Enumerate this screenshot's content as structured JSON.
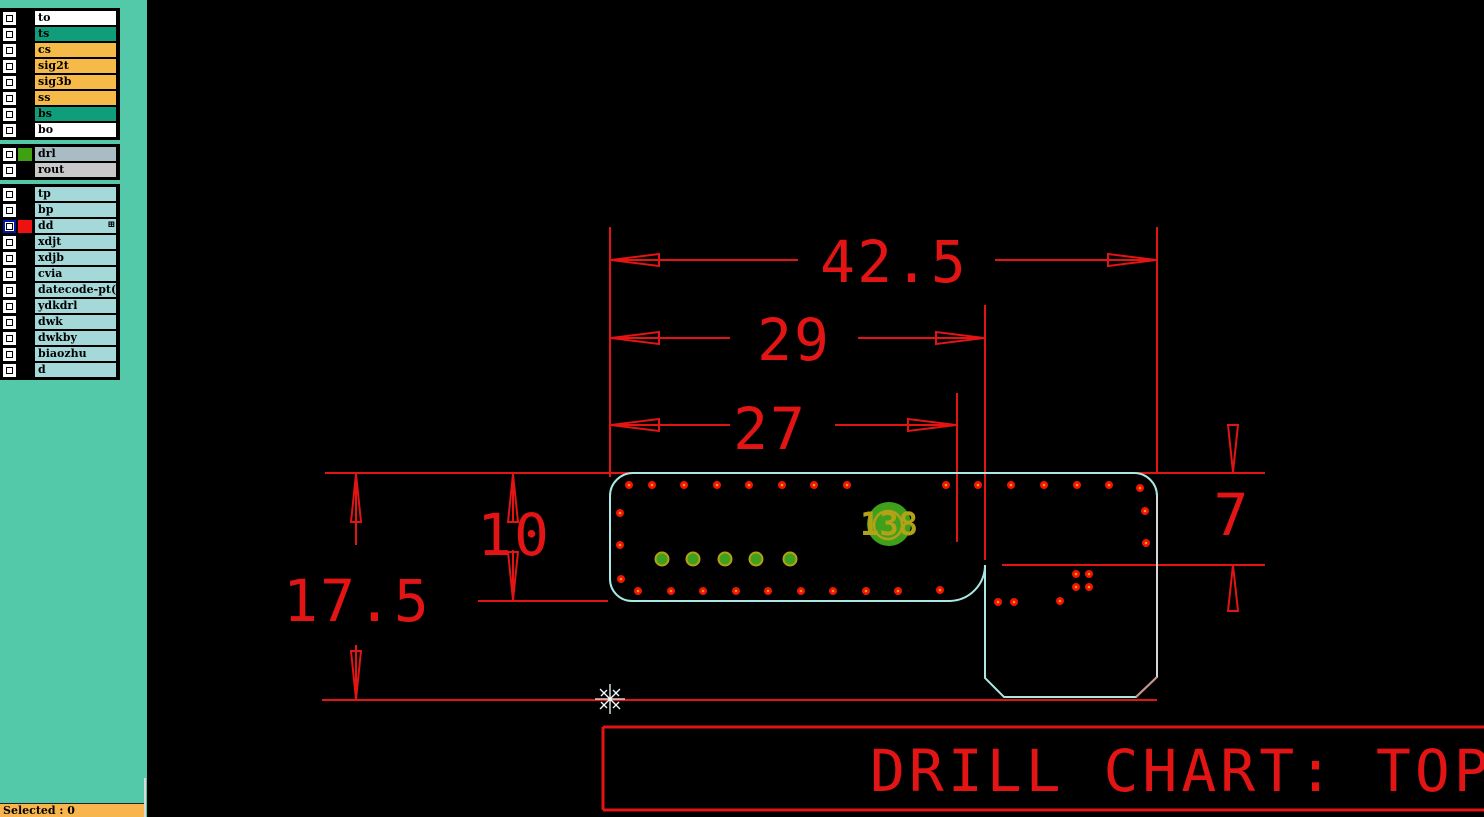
{
  "sidebar": {
    "layer_groups": [
      {
        "rows": [
          {
            "label": "to",
            "bg": "#ffffff"
          },
          {
            "label": "ts",
            "bg": "#0f9e79"
          },
          {
            "label": "cs",
            "bg": "#f6ba49"
          },
          {
            "label": "sig2t",
            "bg": "#f6ba49"
          },
          {
            "label": "sig3b",
            "bg": "#f6ba49"
          },
          {
            "label": "ss",
            "bg": "#f6ba49"
          },
          {
            "label": "bs",
            "bg": "#0f9e79"
          },
          {
            "label": "bo",
            "bg": "#ffffff"
          }
        ]
      },
      {
        "rows": [
          {
            "label": "drl",
            "bg": "#a9bcc4",
            "swatch": "#3fa011"
          },
          {
            "label": "rout",
            "bg": "#c9c9c9"
          }
        ]
      },
      {
        "rows": [
          {
            "label": "tp",
            "bg": "#a5d9d9"
          },
          {
            "label": "bp",
            "bg": "#a5d9d9"
          },
          {
            "label": "dd",
            "bg": "#a5d9d9",
            "swatch": "#ee1111",
            "selected": true,
            "icon": "⊞"
          },
          {
            "label": "xdjt",
            "bg": "#a5d9d9"
          },
          {
            "label": "xdjb",
            "bg": "#a5d9d9"
          },
          {
            "label": "cvia",
            "bg": "#a5d9d9"
          },
          {
            "label": "datecode-pt(",
            "bg": "#a5d9d9"
          },
          {
            "label": "ydkdrl",
            "bg": "#a5d9d9"
          },
          {
            "label": "dwk",
            "bg": "#a5d9d9"
          },
          {
            "label": "dwkby",
            "bg": "#a5d9d9"
          },
          {
            "label": "biaozhu",
            "bg": "#a5d9d9"
          },
          {
            "label": "d",
            "bg": "#a5d9d9"
          }
        ]
      }
    ],
    "status_text": "Selected : 0"
  },
  "canvas": {
    "dimensions": {
      "horizontal": [
        {
          "value": "42.5"
        },
        {
          "value": "29"
        },
        {
          "value": "27"
        }
      ],
      "vertical": [
        {
          "value": "17.5"
        },
        {
          "value": "10"
        },
        {
          "value": "7"
        }
      ]
    },
    "pad_label": "138",
    "drill_chart_title": "DRILL CHART: TOP",
    "colors": {
      "dimension_red": "#e21414",
      "outline_cyan": "#a9e8e4",
      "outline_gray": "#d6d6d6",
      "chamfer_pink": "#cc8e85",
      "drill_red": "#f01408",
      "drill_center_orange": "#ff9d00",
      "pad_green": "#3fa01c",
      "pad_olive": "#b3a118",
      "sidebar_teal": "#53c9a9",
      "status_orange": "#f9b54d"
    },
    "drill_dots": [
      [
        629,
        485
      ],
      [
        652,
        485
      ],
      [
        684,
        485
      ],
      [
        717,
        485
      ],
      [
        749,
        485
      ],
      [
        782,
        485
      ],
      [
        814,
        485
      ],
      [
        847,
        485
      ],
      [
        946,
        485
      ],
      [
        978,
        485
      ],
      [
        1011,
        485
      ],
      [
        1044,
        485
      ],
      [
        1077,
        485
      ],
      [
        1109,
        485
      ],
      [
        1140,
        488
      ],
      [
        620,
        513
      ],
      [
        620,
        545
      ],
      [
        621,
        579
      ],
      [
        638,
        591
      ],
      [
        671,
        591
      ],
      [
        703,
        591
      ],
      [
        736,
        591
      ],
      [
        768,
        591
      ],
      [
        801,
        591
      ],
      [
        833,
        591
      ],
      [
        866,
        591
      ],
      [
        898,
        591
      ],
      [
        940,
        590
      ],
      [
        1145,
        511
      ],
      [
        1146,
        543
      ],
      [
        1076,
        574
      ],
      [
        1089,
        574
      ],
      [
        1076,
        587
      ],
      [
        1089,
        587
      ],
      [
        998,
        602
      ],
      [
        1014,
        602
      ],
      [
        1060,
        601
      ]
    ],
    "green_pads": [
      [
        662,
        559
      ],
      [
        693,
        559
      ],
      [
        725,
        559
      ],
      [
        756,
        559
      ],
      [
        790,
        559
      ]
    ],
    "large_pad": {
      "x": 889,
      "y": 524,
      "r": 22
    }
  }
}
